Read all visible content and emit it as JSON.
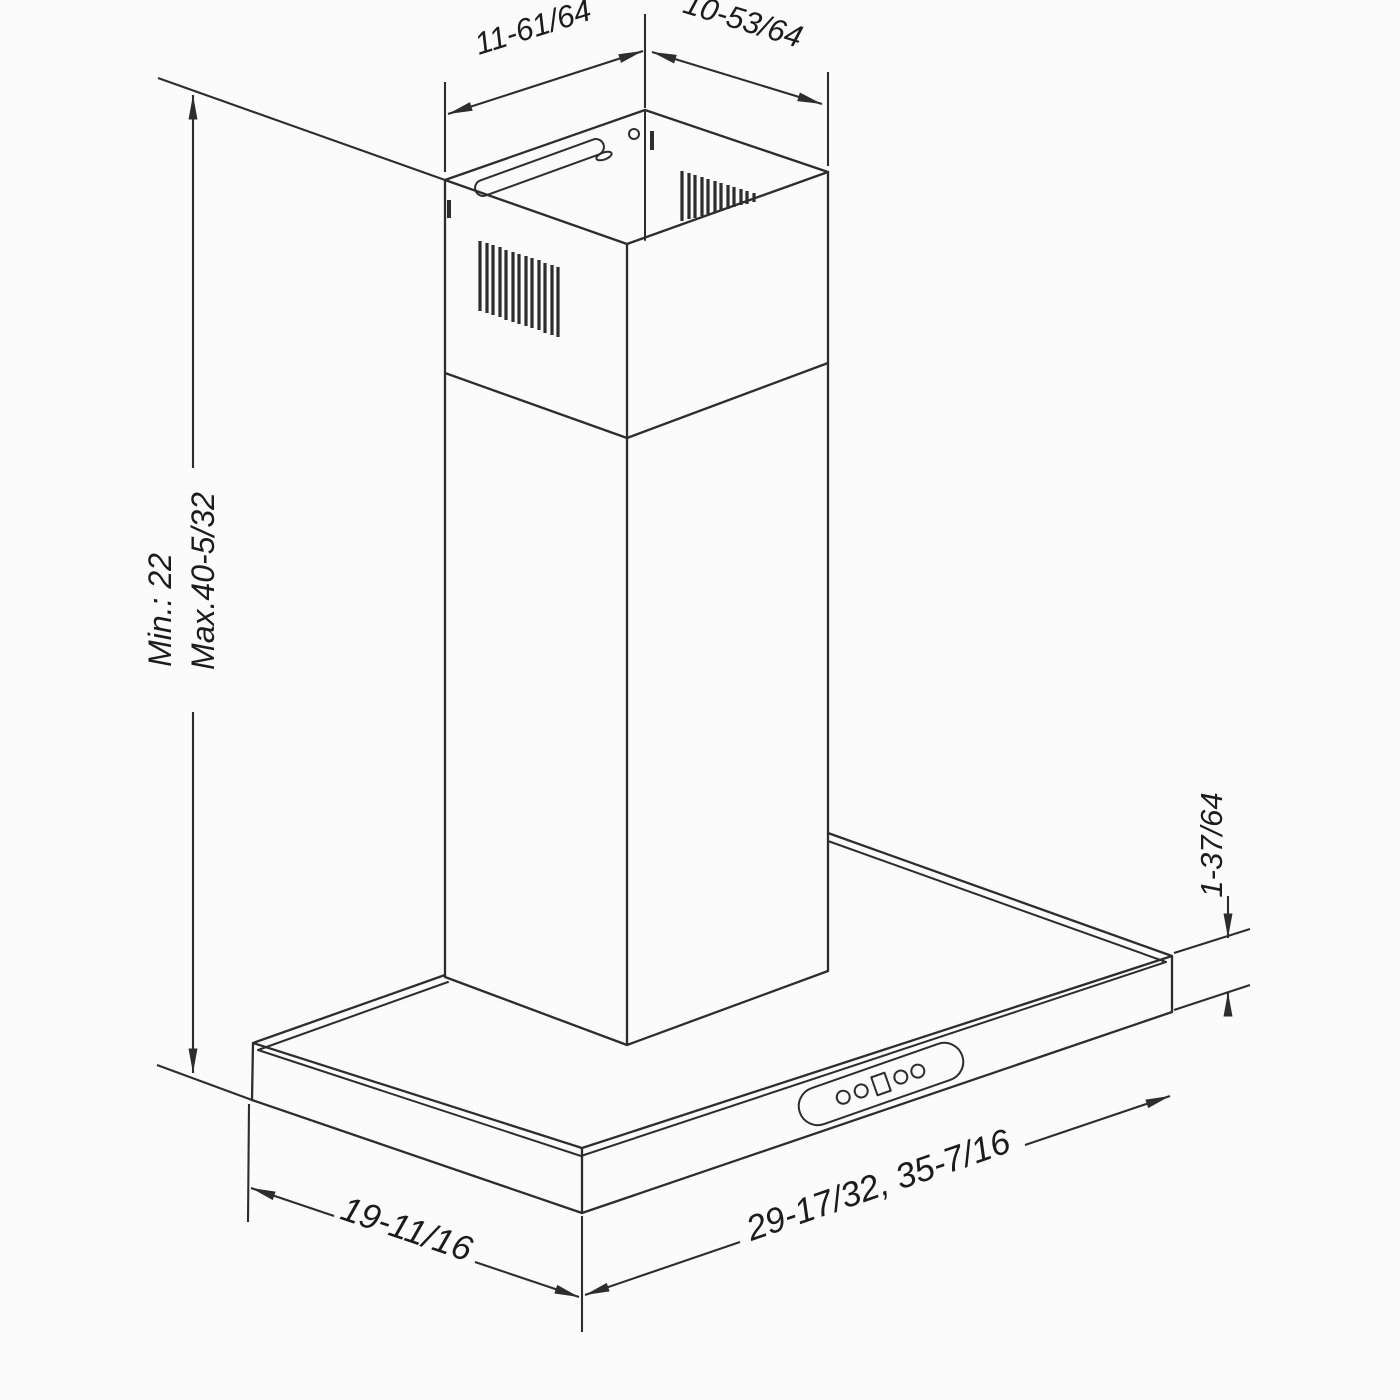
{
  "page": {
    "background": "#fbfbfb",
    "line_color": "#2d2d2d",
    "description": "Isometric dimension line drawing of a wall-mount chimney range hood"
  },
  "drawing": {
    "dimensions": {
      "top_width": "11-61/64",
      "top_depth": "10-53/64",
      "height_min": "Min.: 22",
      "height_max": "Max.40-5/32",
      "hood_height": "1-37/64",
      "hood_depth": "19-11/16",
      "hood_width": "29-17/32, 35-7/16"
    }
  }
}
